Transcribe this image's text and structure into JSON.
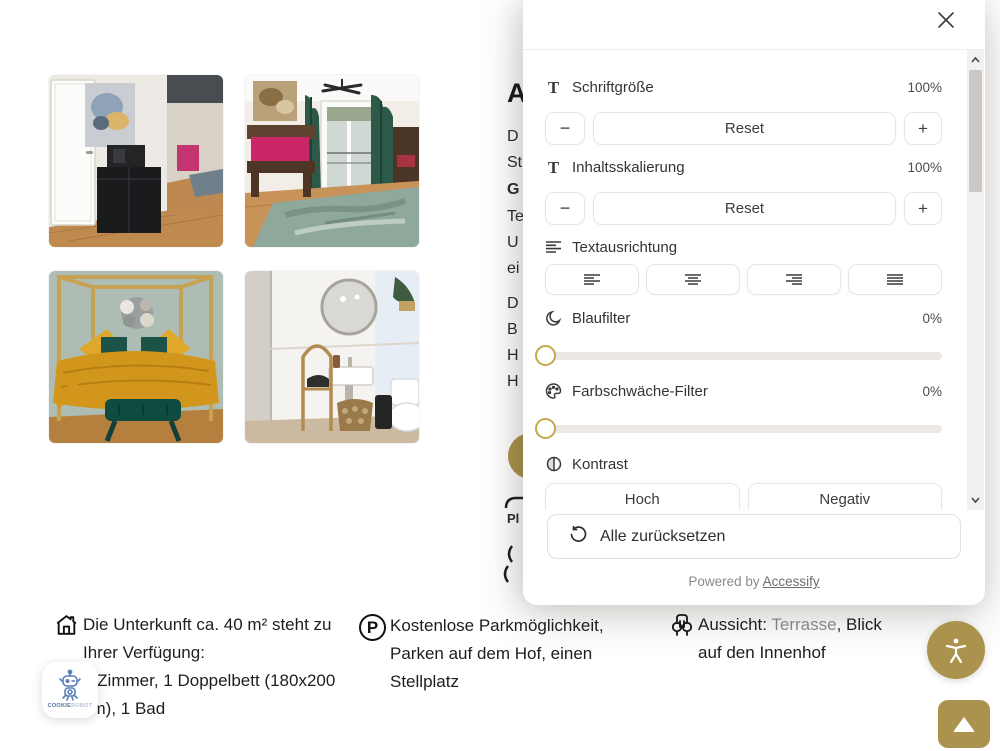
{
  "colors": {
    "accent_gold": "#ab934d",
    "dark_text": "#1f1f1f",
    "muted_text": "#8d8d8d"
  },
  "accessibility_panel": {
    "font_size": {
      "label": "Schriftgröße",
      "value": "100%",
      "minus": "−",
      "reset": "Reset",
      "plus": "+"
    },
    "content_scaling": {
      "label": "Inhaltsskalierung",
      "value": "100%",
      "minus": "−",
      "reset": "Reset",
      "plus": "+"
    },
    "text_alignment": {
      "label": "Textausrichtung"
    },
    "blue_filter": {
      "label": "Blaufilter",
      "value": "0%"
    },
    "color_weakness_filter": {
      "label": "Farbschwäche-Filter",
      "value": "0%"
    },
    "contrast": {
      "label": "Kontrast",
      "options": [
        "Hoch",
        "Negativ"
      ]
    },
    "reset_all": "Alle zurücksetzen",
    "powered_by_prefix": "Powered by",
    "powered_by_link": "Accessify"
  },
  "page": {
    "fragments": [
      "A",
      "D",
      "St",
      "G",
      "Te",
      "U",
      "ei",
      "D",
      "B",
      "H",
      "H",
      "Pl"
    ],
    "features": [
      {
        "lines": [
          "Die Unterkunft ca. 40 m² steht zu",
          "Ihrer Verfügung:",
          "2 Zimmer, 1 Doppelbett (180x200",
          "cm), 1 Bad"
        ]
      },
      {
        "lines": [
          "Kostenlose Parkmöglichkeit,",
          "Parken auf dem Hof, einen",
          "Stellplatz"
        ]
      },
      {
        "line1_prefix": "Aussicht: ",
        "line1_muted": "Terrasse",
        "line1_suffix": ", Blick",
        "line2": "auf den Innenhof"
      }
    ],
    "parking_icon_letter": "P"
  },
  "cookie_widget": {
    "brand_primary": "COOKIE",
    "brand_secondary": "ROBOT"
  }
}
